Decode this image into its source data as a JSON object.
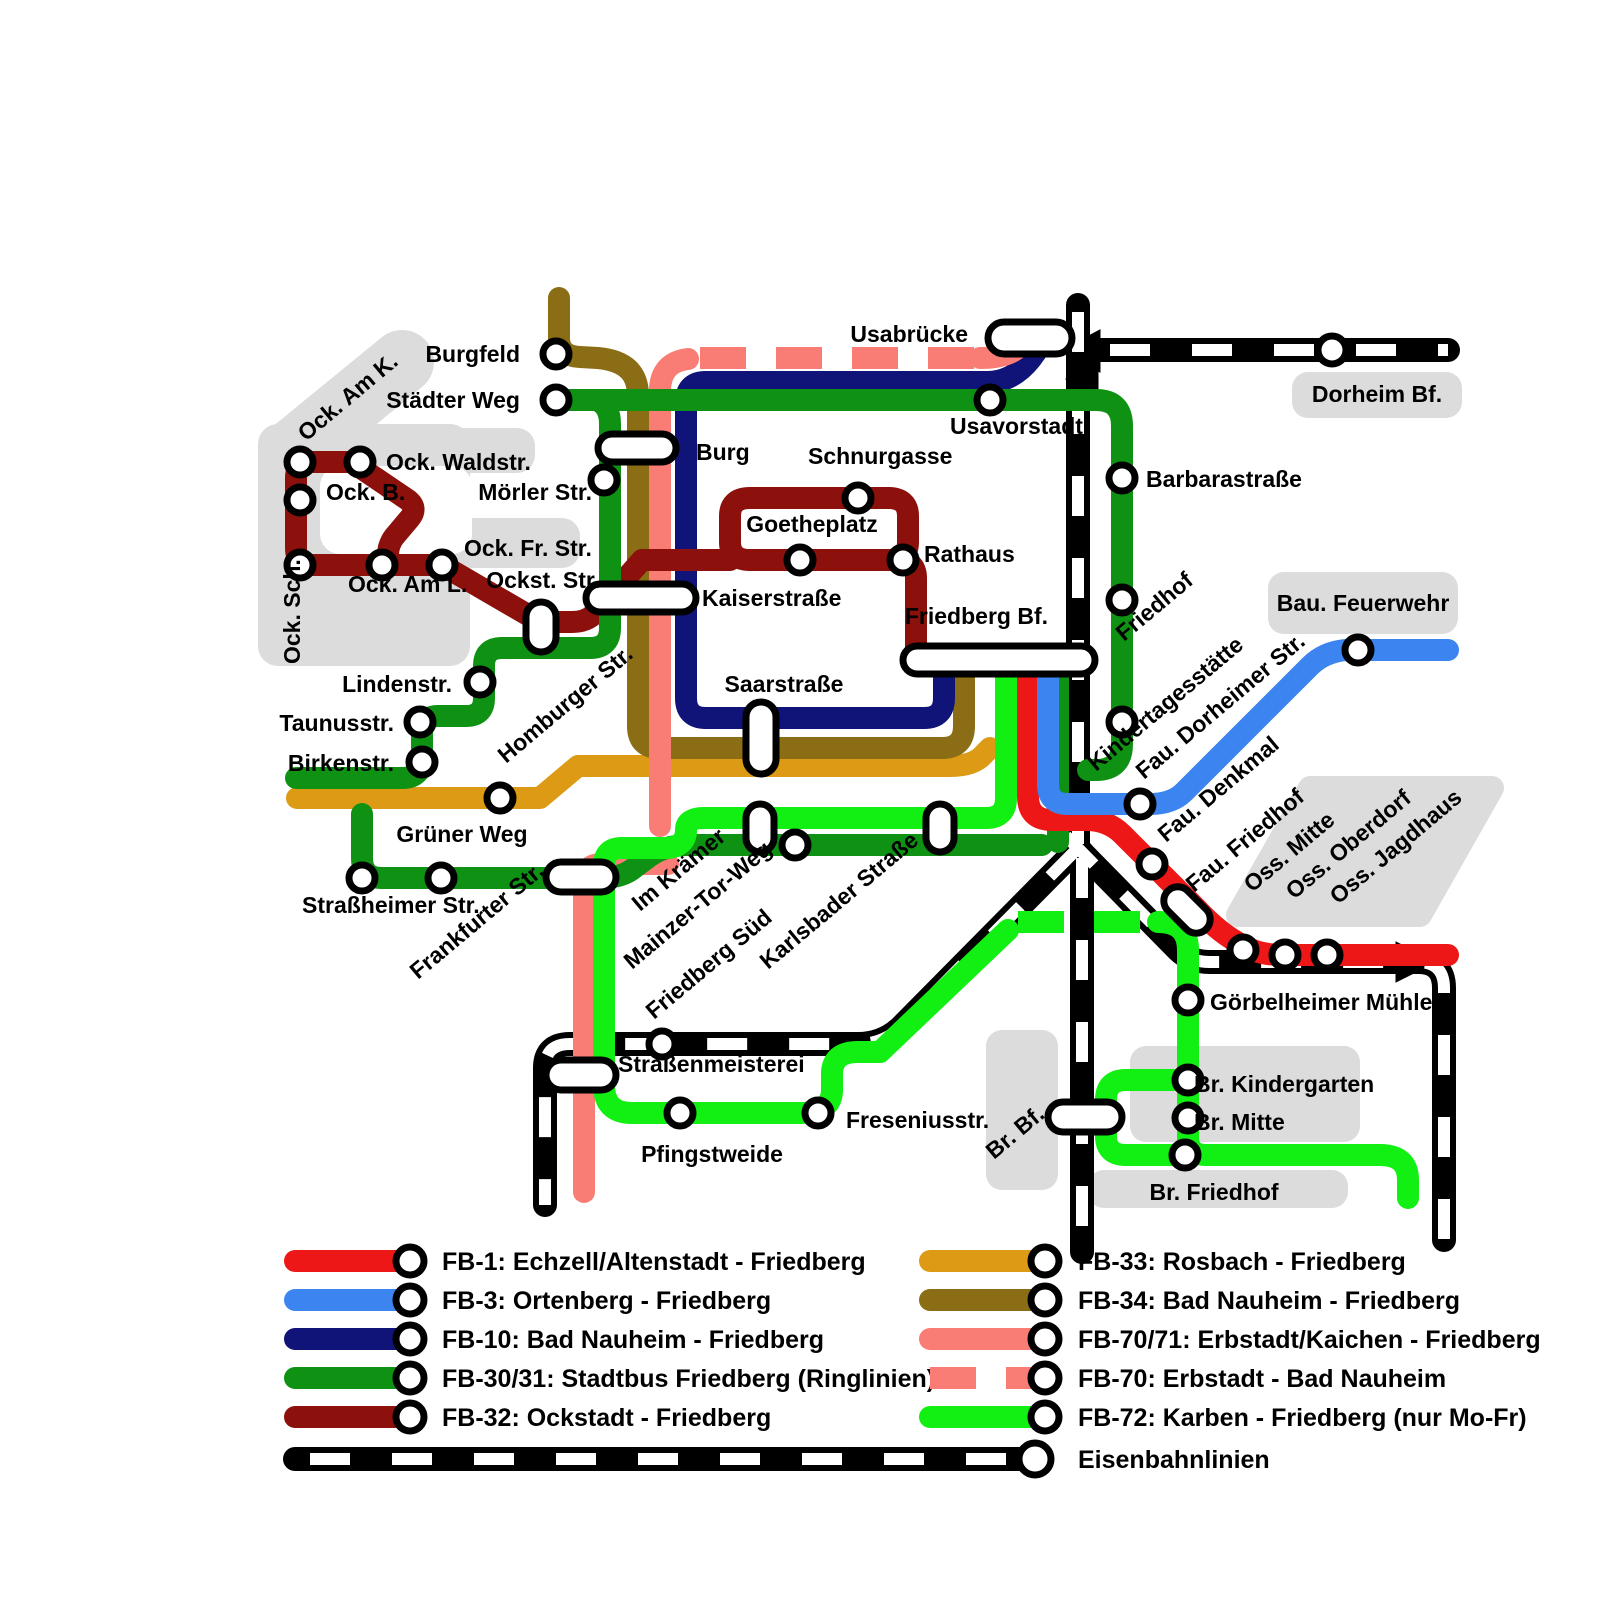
{
  "colors": {
    "background": "#ffffff",
    "label": "#000000",
    "area_gray": "#dcdcdc",
    "station_fill": "#ffffff",
    "station_stroke": "#000000"
  },
  "lines": {
    "fb1": {
      "name": "FB-1",
      "color": "#ee1717"
    },
    "fb3": {
      "name": "FB-3",
      "color": "#3c85f0"
    },
    "fb10": {
      "name": "FB-10",
      "color": "#101377"
    },
    "fb3031": {
      "name": "FB-30/31",
      "color": "#0f9114"
    },
    "fb32": {
      "name": "FB-32",
      "color": "#8c100c"
    },
    "fb33": {
      "name": "FB-33",
      "color": "#dd9a14"
    },
    "fb34": {
      "name": "FB-34",
      "color": "#8a6d14"
    },
    "fb7071": {
      "name": "FB-70/71",
      "color": "#f97d74"
    },
    "fb70": {
      "name": "FB-70",
      "color": "#f97d74",
      "style": "dashed"
    },
    "fb72": {
      "name": "FB-72",
      "color": "#12ef12"
    },
    "rail": {
      "name": "Eisenbahn",
      "color": "#000000",
      "dash_color": "#ffffff"
    }
  },
  "legend": {
    "left": [
      {
        "line": "fb1",
        "label": "FB-1: Echzell/Altenstadt - Friedberg"
      },
      {
        "line": "fb3",
        "label": "FB-3: Ortenberg - Friedberg"
      },
      {
        "line": "fb10",
        "label": "FB-10: Bad Nauheim - Friedberg"
      },
      {
        "line": "fb3031",
        "label": "FB-30/31: Stadtbus Friedberg (Ringlinien)"
      },
      {
        "line": "fb32",
        "label": "FB-32: Ockstadt - Friedberg"
      }
    ],
    "right": [
      {
        "line": "fb33",
        "label": "FB-33: Rosbach - Friedberg"
      },
      {
        "line": "fb34",
        "label": "FB-34: Bad Nauheim - Friedberg"
      },
      {
        "line": "fb7071",
        "label": "FB-70/71: Erbstadt/Kaichen - Friedberg"
      },
      {
        "line": "fb70",
        "label": "FB-70: Erbstadt - Bad Nauheim"
      },
      {
        "line": "fb72",
        "label": "FB-72: Karben - Friedberg (nur Mo-Fr)"
      }
    ],
    "railway": {
      "label": "Eisenbahnlinien"
    }
  },
  "stations": {
    "burgfeld": {
      "label": "Burgfeld"
    },
    "staedterweg": {
      "label": "Städter Weg"
    },
    "ockamk": {
      "label": "Ock. Am K."
    },
    "ockwaldstr": {
      "label": "Ock. Waldstr."
    },
    "ockb": {
      "label": "Ock. B."
    },
    "ockfrstr": {
      "label": "Ock. Fr. Str."
    },
    "ockaml": {
      "label": "Ock. Am L."
    },
    "ocksch": {
      "label": "Ock. Sch."
    },
    "moerlerstr": {
      "label": "Mörler Str."
    },
    "burg": {
      "label": "Burg"
    },
    "schnurgasse": {
      "label": "Schnurgasse"
    },
    "usabruecke": {
      "label": "Usabrücke"
    },
    "usavorstadt": {
      "label": "Usavorstadt"
    },
    "dorheimbf": {
      "label": "Dorheim Bf."
    },
    "barbarastrasse": {
      "label": "Barbarastraße"
    },
    "friedhof": {
      "label": "Friedhof"
    },
    "kindertagesstaette": {
      "label": "Kindertagesstätte"
    },
    "baufeuerwehr": {
      "label": "Bau. Feuerwehr"
    },
    "faudorheimerstr": {
      "label": "Fau. Dorheimer Str."
    },
    "faudenkmal": {
      "label": "Fau. Denkmal"
    },
    "faufriedhof": {
      "label": "Fau. Friedhof"
    },
    "ossmitte": {
      "label": "Oss. Mitte"
    },
    "ossoberdorf": {
      "label": "Oss. Oberdorf"
    },
    "ossjagdhaus": {
      "label": "Oss. Jagdhaus"
    },
    "kaiserstrasse": {
      "label": "Kaiserstraße"
    },
    "ockststr": {
      "label": "Ockst. Str."
    },
    "goetheplatz": {
      "label": "Goetheplatz"
    },
    "rathaus": {
      "label": "Rathaus"
    },
    "friedbergbf": {
      "label": "Friedberg Bf."
    },
    "saarstrasse": {
      "label": "Saarstraße"
    },
    "lindenstr": {
      "label": "Lindenstr."
    },
    "taunusstr": {
      "label": "Taunusstr."
    },
    "birkenstr": {
      "label": "Birkenstr."
    },
    "homburgerstr": {
      "label": "Homburger Str."
    },
    "gruenerweg": {
      "label": "Grüner Weg"
    },
    "strassheimerstr": {
      "label": "Straßheimer Str."
    },
    "frankfurterstr": {
      "label": "Frankfurter Str."
    },
    "imkraemer": {
      "label": "Im Krämer"
    },
    "mainzertorweg": {
      "label": "Mainzer-Tor-Weg"
    },
    "friedbergsued": {
      "label": "Friedberg Süd"
    },
    "karlsbaderstrasse": {
      "label": "Karlsbader Straße"
    },
    "strassenmeisterei": {
      "label": "Straßenmeisterei"
    },
    "pfingstweide": {
      "label": "Pfingstweide"
    },
    "freseniusstr": {
      "label": "Freseniusstr."
    },
    "goerbelheimermuehle": {
      "label": "Görbelheimer Mühle"
    },
    "brkindergarten": {
      "label": "Br. Kindergarten"
    },
    "brmitte": {
      "label": "Br. Mitte"
    },
    "brfriedhof": {
      "label": "Br. Friedhof"
    },
    "brbf": {
      "label": "Br. Bf."
    }
  }
}
